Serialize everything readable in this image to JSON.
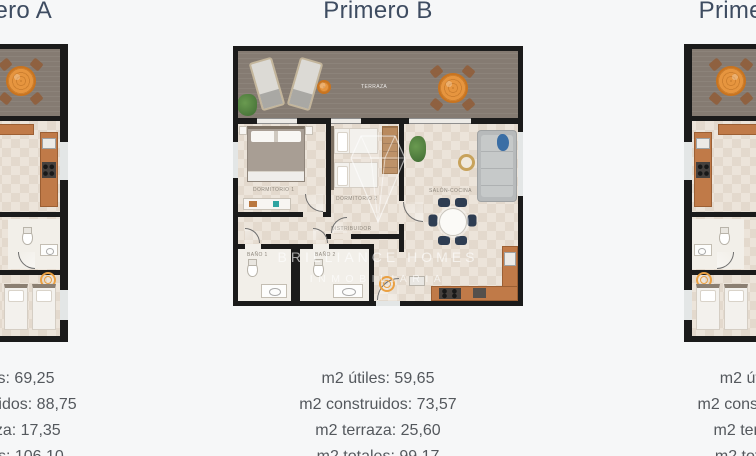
{
  "page": {
    "background": "#f6f7f8"
  },
  "watermark": {
    "line1": "BRILLIANCE HOMES",
    "line2": "INMOBILIARIA"
  },
  "colors": {
    "title_text": "#3e4c61",
    "stats_text": "#54585d",
    "plan_wall": "#1b1b1b",
    "terrace_floor": "#857b72",
    "interior_floor": "#ece4da",
    "kitchen_wood": "#c07a48",
    "accent_orange": "#e6953f",
    "sofa_gray": "#b7babb",
    "chair_navy": "#2e3d52"
  },
  "units": [
    {
      "title": "Primero A",
      "stats": [
        "m2 útiles: 69,25",
        "m2 construidos: 88,75",
        "m2 terraza: 17,35",
        "m2 totales: 106,10"
      ]
    },
    {
      "title": "Primero B",
      "stats": [
        "m2 útiles: 59,65",
        "m2 construidos: 73,57",
        "m2 terraza: 25,60",
        "m2 totales: 99,17"
      ],
      "rooms": {
        "terrace": "TERRAZA",
        "bedroom1": "DORMITORIO 1",
        "bedroom2": "DORMITORIO 2",
        "living": "SALÓN-COCINA",
        "bath1": "BAÑO 1",
        "bath2": "BAÑO 2",
        "hall": "DISTRIBUIDOR"
      }
    },
    {
      "title": "Primero C",
      "stats": [
        "m2 útiles:",
        "m2 construidos:",
        "m2 terraza:",
        "m2 totales:"
      ]
    }
  ]
}
